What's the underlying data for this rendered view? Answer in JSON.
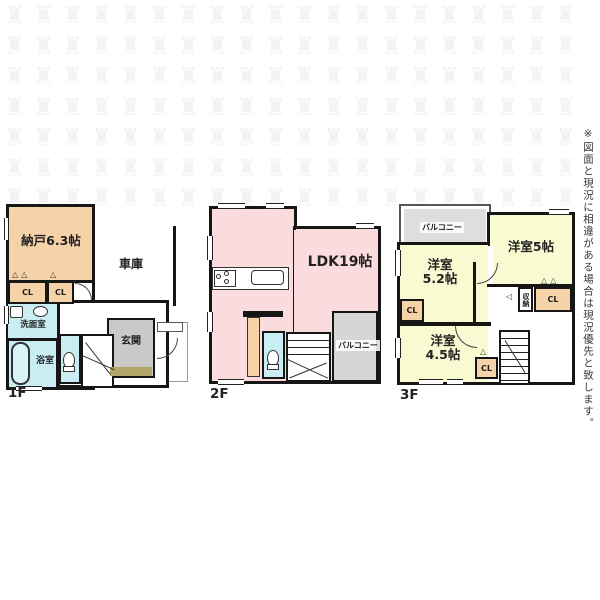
{
  "disclaimer": "※図面と現況に相違がある場合は現況優先と致します。",
  "watermark": {
    "glyph": "♜",
    "rows": 7,
    "cols": 20
  },
  "colors": {
    "room_peach": "#f6d2a9",
    "room_pink": "#fadbde",
    "room_yellow": "#f9fad2",
    "room_cyan": "#c9edf2",
    "entry_gray": "#c9c9c9",
    "entry_step_tan": "#b2a668",
    "balcony_gray": "#d6d6d6",
    "wall_black": "#161616"
  },
  "floors": {
    "f1": {
      "label": "1F",
      "nando": "納戸6.3帖",
      "garage": "車庫",
      "cl_a": "CL",
      "cl_b": "CL",
      "senmen": "洗面室",
      "bath": "浴室",
      "genkan": "玄関"
    },
    "f2": {
      "label": "2F",
      "ldk": "LDK19帖",
      "balcony": "バルコニー"
    },
    "f3": {
      "label": "3F",
      "balcony": "バルコニー",
      "room52_line1": "洋室",
      "room52_line2": "5.2帖",
      "room5": "洋室5帖",
      "room45_line1": "洋室",
      "room45_line2": "4.5帖",
      "shuno": "収納",
      "cl_left": "CL",
      "cl_mid": "CL",
      "cl_bottom": "CL"
    }
  }
}
